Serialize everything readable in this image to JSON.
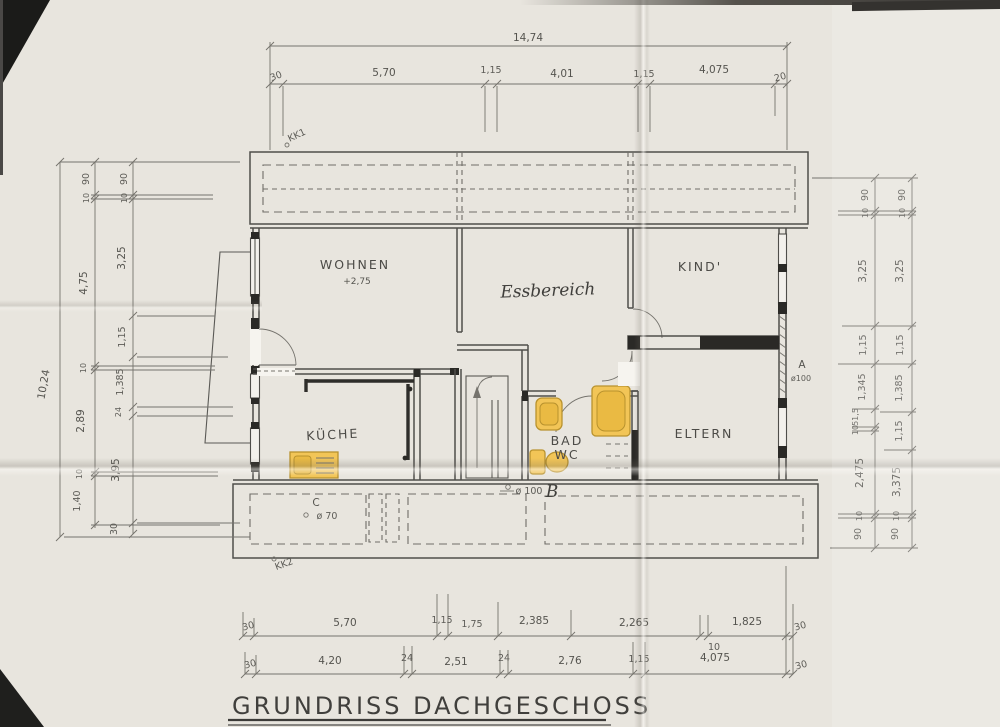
{
  "title": "GRUNDRISS DACHGESCHOSS",
  "rooms": {
    "wohnen": "WOHNEN",
    "wohnen_level": "+2,75",
    "essbereich": "Essbereich",
    "kind": "KIND'",
    "kueche": "KÜCHE",
    "bad": "BAD",
    "wc": "WC",
    "eltern": "ELTERN"
  },
  "annotations": {
    "kk1": "KK1",
    "kk2": "KK2",
    "a_letter": "A",
    "a_dia": "ø100",
    "b_dia": "ø 100",
    "b_letter": "B",
    "c_letter": "C",
    "c_dia": "ø 70"
  },
  "dims": {
    "top_total": "14,74",
    "left_total": "10,24",
    "top": [
      "30",
      "5,70",
      "1,15",
      "4,01",
      "1,15",
      "4,075",
      "20"
    ],
    "bottom_upper": [
      "30",
      "5,70",
      "1,15",
      "1,75",
      "2,385",
      "2,265",
      "10",
      "1,825",
      "30"
    ],
    "bottom_lower": [
      "30",
      "4,20",
      "24",
      "2,51",
      "24",
      "2,76",
      "1,15",
      "4,075",
      "30"
    ],
    "left_mid": [
      "90",
      "10",
      "4,75",
      "10",
      "2,89",
      "10",
      "1,40"
    ],
    "left_inner": [
      "90",
      "10",
      "3,25",
      "1,15",
      "1,385",
      "24",
      "3,95",
      "30"
    ],
    "right_inner": [
      "90",
      "10",
      "3,25",
      "1,15",
      "1,345",
      "51,5",
      "10",
      "2,475",
      "10",
      "90"
    ],
    "right_outer": [
      "90",
      "10",
      "3,25",
      "1,15",
      "1,385",
      "1,15",
      "3,375",
      "10",
      "90"
    ]
  },
  "colors": {
    "paper": "#e8e5de",
    "ink": "#4f4e4a",
    "pencil": "#75736d",
    "fixture_fill": "#f2c557",
    "fixture_stroke": "#b8922e"
  }
}
